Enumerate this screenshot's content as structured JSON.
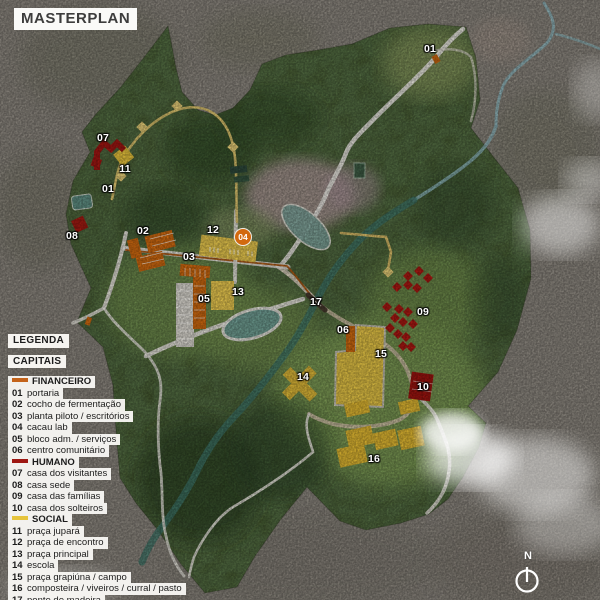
{
  "title": "MASTERPLAN",
  "legend": {
    "heading": "LEGENDA",
    "subheading": "CAPITAIS",
    "sections": [
      {
        "name": "FINANCEIRO",
        "color": "#c4631a",
        "items": [
          {
            "num": "01",
            "label": "portaria"
          },
          {
            "num": "02",
            "label": "cocho de fermentação"
          },
          {
            "num": "03",
            "label": "planta piloto / escritórios"
          },
          {
            "num": "04",
            "label": "cacau lab"
          },
          {
            "num": "05",
            "label": "bloco adm. / serviços"
          },
          {
            "num": "06",
            "label": "centro comunitário"
          }
        ]
      },
      {
        "name": "HUMANO",
        "color": "#9e1712",
        "items": [
          {
            "num": "07",
            "label": "casa dos visitantes"
          },
          {
            "num": "08",
            "label": "casa sede"
          },
          {
            "num": "09",
            "label": "casa das famílias"
          },
          {
            "num": "10",
            "label": "casa dos solteiros"
          }
        ]
      },
      {
        "name": "SOCIAL",
        "color": "#e6c43c",
        "items": [
          {
            "num": "11",
            "label": "praça jupará"
          },
          {
            "num": "12",
            "label": "praça de encontro"
          },
          {
            "num": "13",
            "label": "praça principal"
          },
          {
            "num": "14",
            "label": "escola"
          },
          {
            "num": "15",
            "label": "praça grapiúna / campo"
          },
          {
            "num": "16",
            "label": "composteira / viveiros / curral / pasto"
          },
          {
            "num": "17",
            "label": "ponte de madeira"
          }
        ]
      }
    ]
  },
  "compass": {
    "label": "N"
  },
  "map": {
    "labels": [
      {
        "text": "01",
        "x": 430,
        "y": 49
      },
      {
        "text": "01",
        "x": 108,
        "y": 189
      },
      {
        "text": "02",
        "x": 143,
        "y": 231
      },
      {
        "text": "03",
        "x": 189,
        "y": 257
      },
      {
        "text": "05",
        "x": 204,
        "y": 299
      },
      {
        "text": "06",
        "x": 343,
        "y": 330
      },
      {
        "text": "07",
        "x": 103,
        "y": 138
      },
      {
        "text": "08",
        "x": 72,
        "y": 236
      },
      {
        "text": "09",
        "x": 423,
        "y": 312
      },
      {
        "text": "10",
        "x": 423,
        "y": 387
      },
      {
        "text": "11",
        "x": 125,
        "y": 169
      },
      {
        "text": "12",
        "x": 213,
        "y": 230
      },
      {
        "text": "13",
        "x": 238,
        "y": 292
      },
      {
        "text": "14",
        "x": 303,
        "y": 377
      },
      {
        "text": "15",
        "x": 381,
        "y": 354
      },
      {
        "text": "16",
        "x": 374,
        "y": 459
      },
      {
        "text": "17",
        "x": 316,
        "y": 302
      }
    ],
    "badges": [
      {
        "text": "04",
        "x": 243,
        "y": 237,
        "color": "#d2690f"
      }
    ]
  },
  "colors": {
    "financeiro": "#d06a10",
    "humano": "#a21712",
    "social": "#e6c43c",
    "river": "#3f7569",
    "road": "#eae8e1"
  }
}
